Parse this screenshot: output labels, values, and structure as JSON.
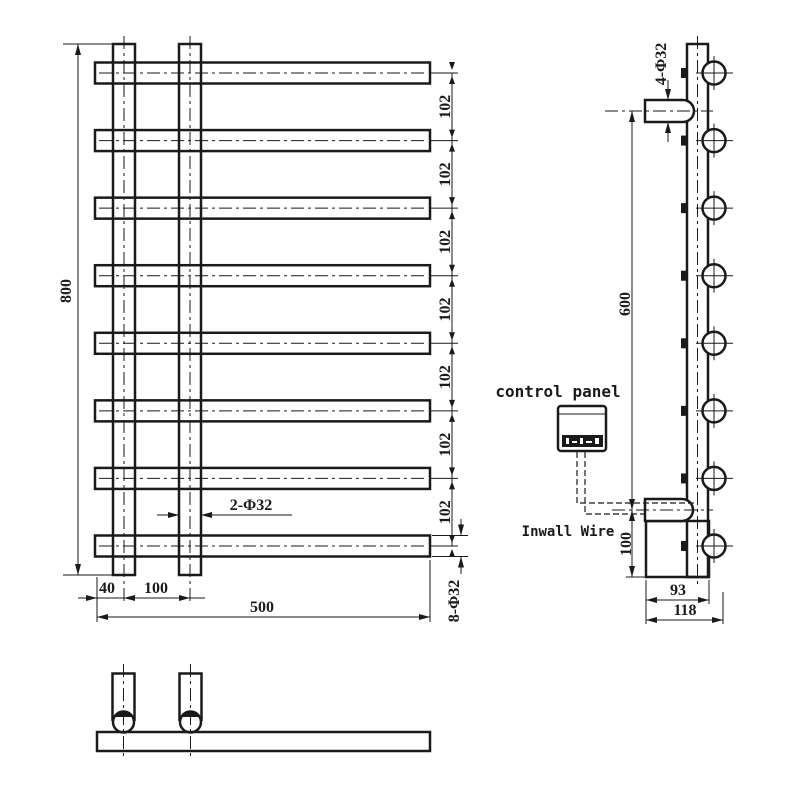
{
  "front_view": {
    "overall_height": "800",
    "bar_spacing": "102",
    "spacing_count": 7,
    "bar_count": 8,
    "posts_diameter_label": "2-Φ32",
    "bars_diameter_label": "8-Φ32",
    "edge_to_post": "40",
    "post_spacing": "100",
    "overall_width": "500"
  },
  "side_view": {
    "brackets_diameter_label": "4-Φ32",
    "bracket_span": "600",
    "bottom_section_height": "100",
    "body_depth": "93",
    "overall_depth": "118",
    "bar_end_count": 8,
    "control_panel_label": "control panel",
    "wire_label": "Inwall Wire"
  },
  "colors": {
    "ink": "#1a1a1a",
    "paper": "#ffffff"
  }
}
